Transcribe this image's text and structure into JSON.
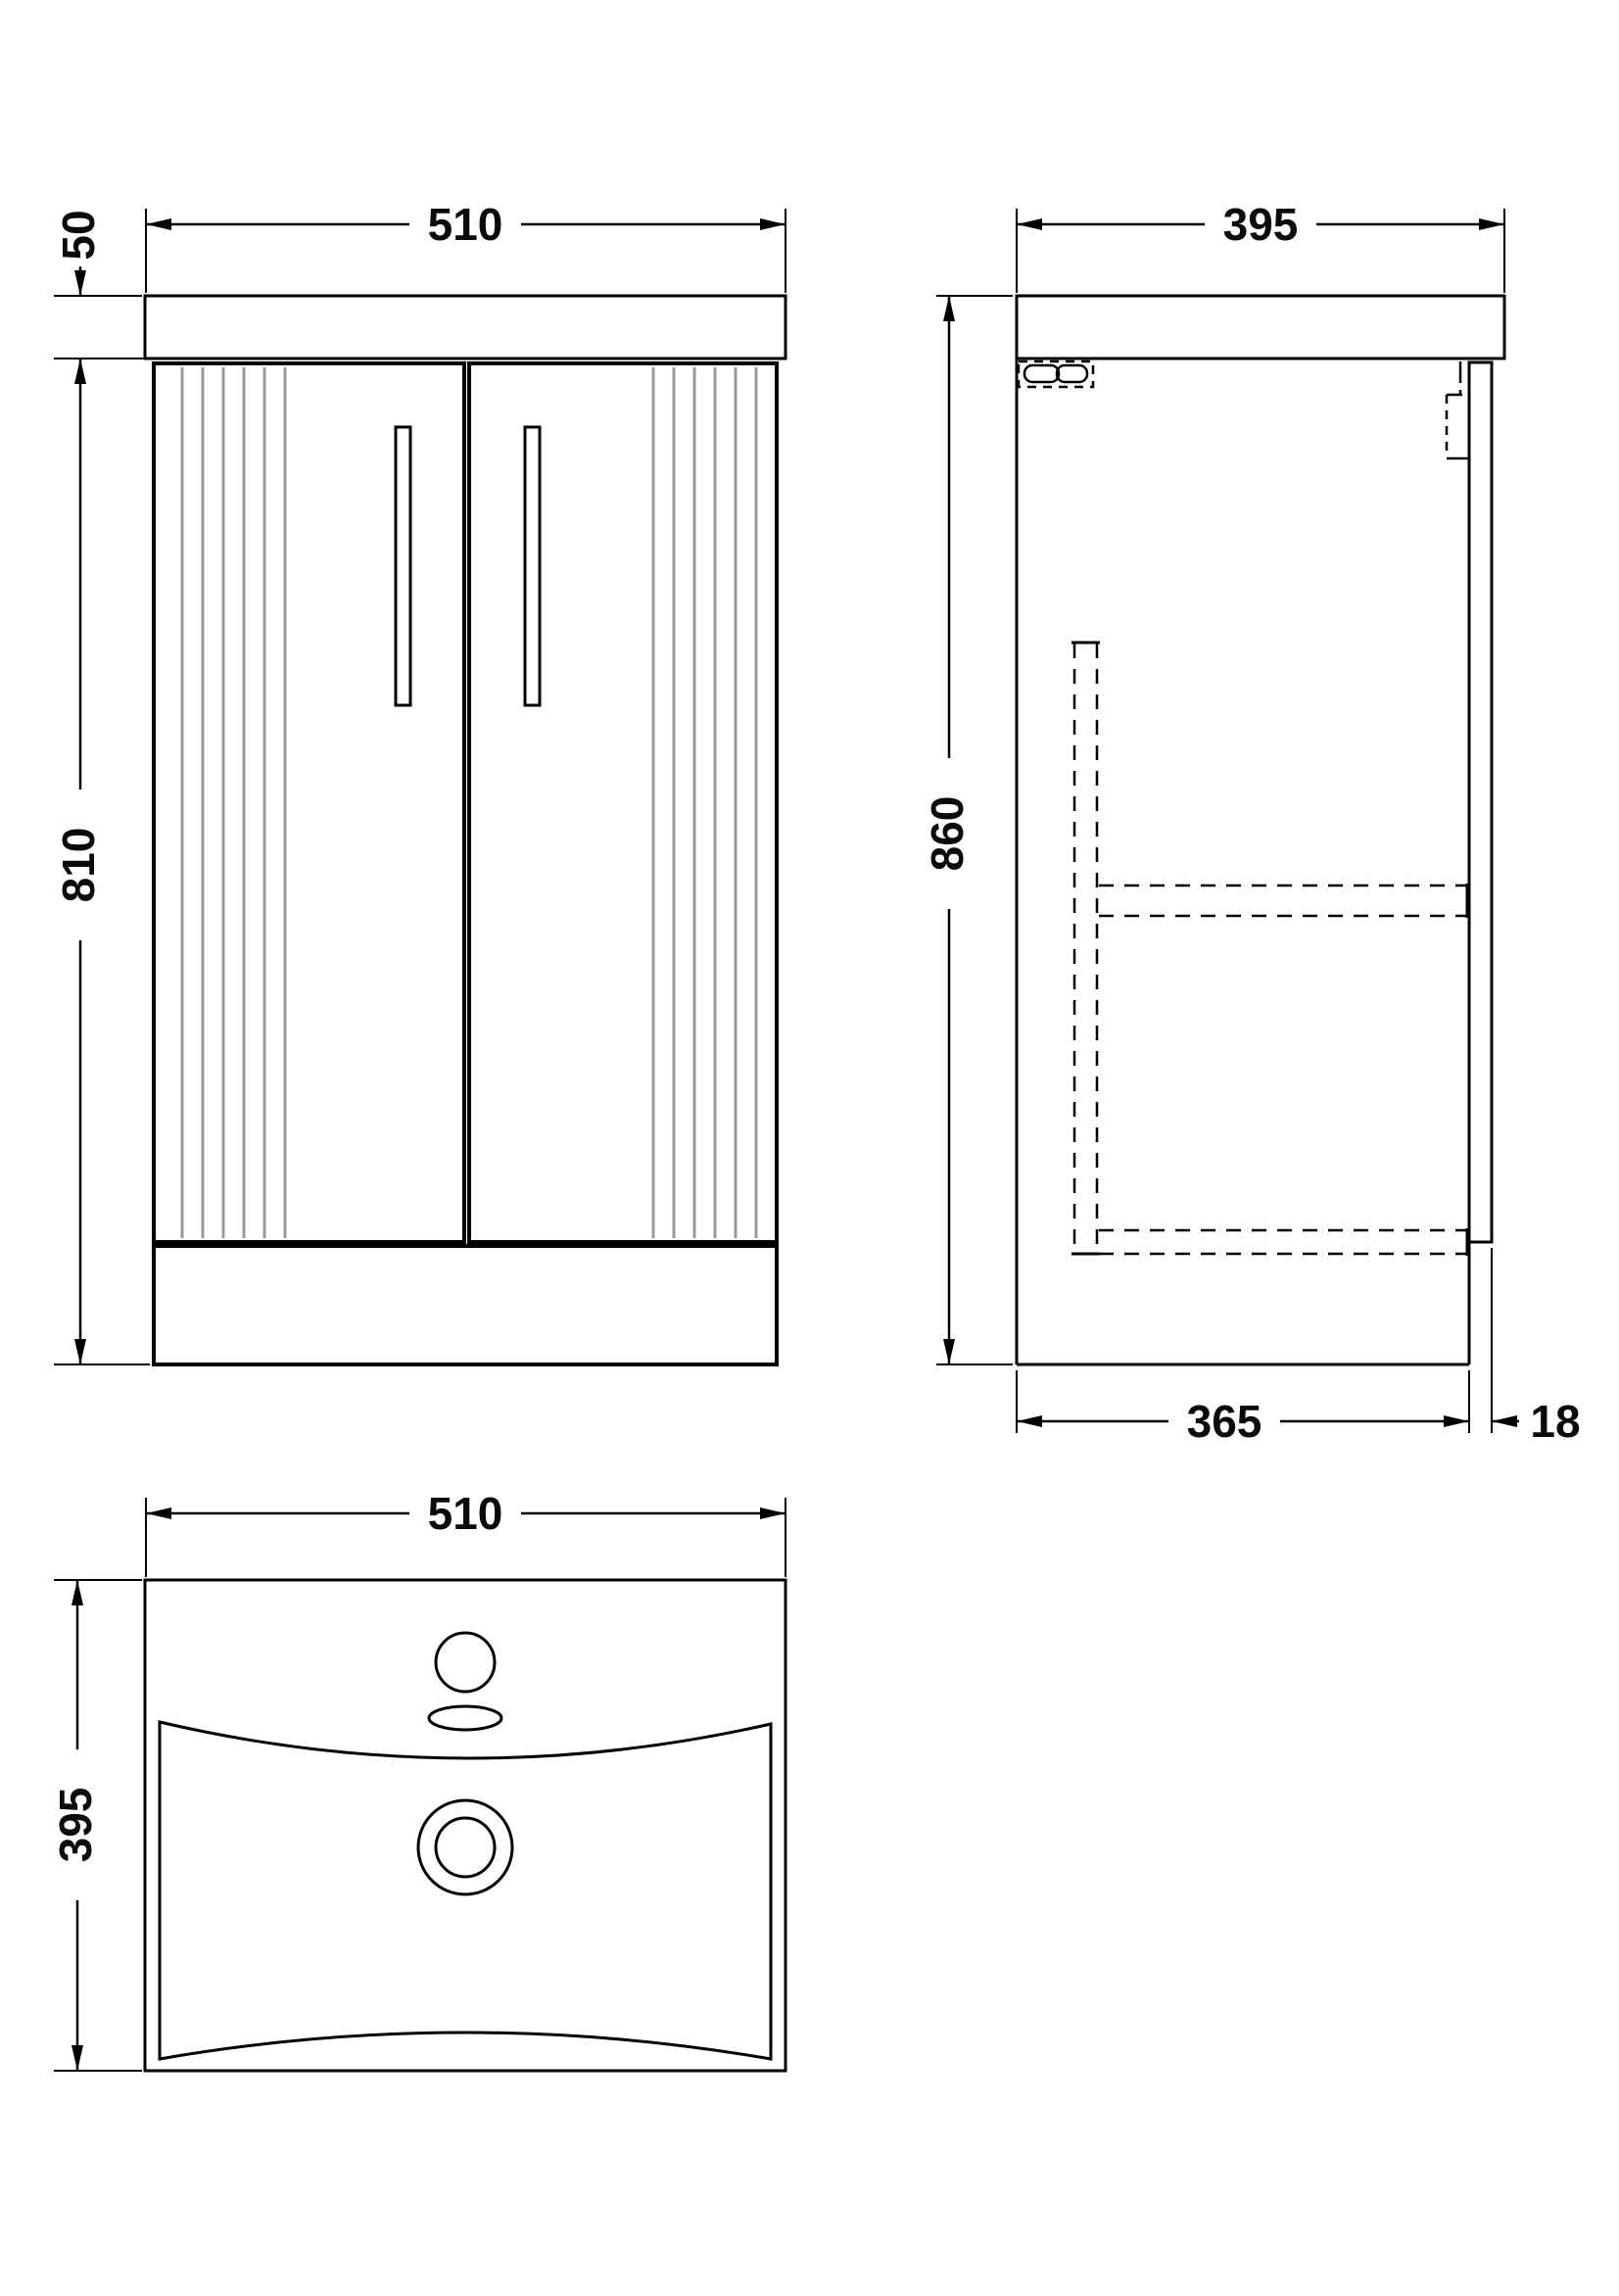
{
  "drawing": {
    "kind": "technical-dimension-drawing",
    "subject": "floor-standing bathroom vanity unit with fluted double doors and basin",
    "units": "mm",
    "background_color": "#ffffff",
    "line_color": "#000000",
    "flute_line_color": "#999999",
    "views": {
      "front": {
        "name": "front elevation",
        "width": "510",
        "worktop_height": "50",
        "cabinet_height": "810"
      },
      "side": {
        "name": "side elevation",
        "depth": "395",
        "overall_height": "860",
        "carcass_depth": "365",
        "door_thickness": "18"
      },
      "plan": {
        "name": "basin plan view",
        "width": "510",
        "depth": "395"
      }
    }
  }
}
